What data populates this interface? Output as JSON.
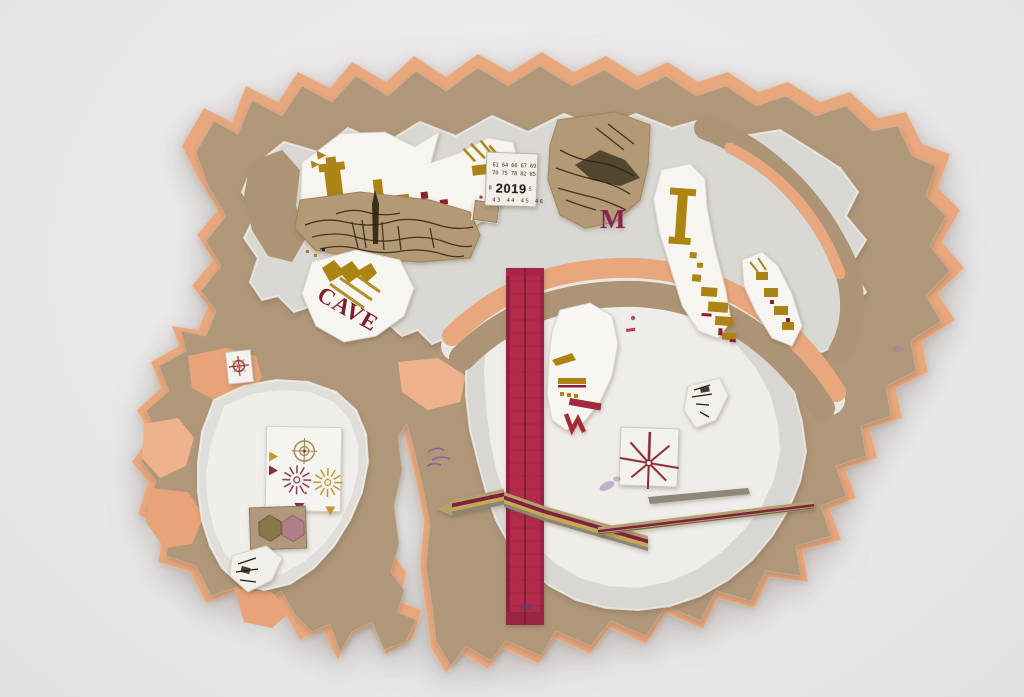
{
  "artwork": {
    "background_color": "#e9e7e7",
    "palette": {
      "peach_cardboard": "#e9a77d",
      "kraft_cardboard": "#b0977a",
      "painted_layer": "#dad8d3",
      "paper_white": "#f6f4ef",
      "label_gold": "#ab8414",
      "wine_maroon": "#7e1e2b",
      "tape_red": "#b22b49",
      "magenta_ink": "#8a2056",
      "violet_ink": "#7b58a0",
      "etching_ink": "#2c2315"
    },
    "labels": {
      "vintage_stamp": {
        "row1": "61 64 66 67 69",
        "row2": "70 75 78 82 85",
        "left_digit": "8",
        "year": "2019",
        "right_digit": "5",
        "row3": "43 44 45 46"
      },
      "cave_text": "CAVE",
      "m_letter": "M"
    }
  }
}
